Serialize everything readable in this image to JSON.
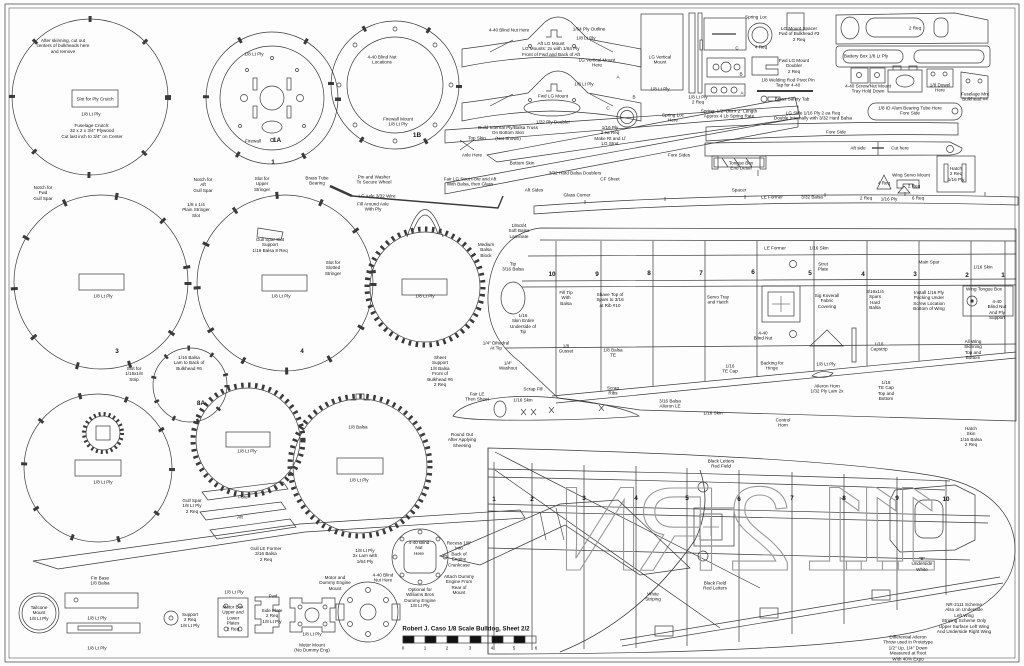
{
  "sheet": {
    "title": "Robert J. Caso 1/8 Scale Bulldog, Sheet 2/2",
    "line_color": "#3a3a3a",
    "letter_color": "#9a9a9a"
  },
  "registration": {
    "letters": [
      "N",
      "R",
      "2",
      "1",
      "1",
      "1"
    ],
    "x": [
      600,
      678,
      760,
      837,
      874,
      910
    ],
    "y": 570,
    "meaning": "NR-2111 registration drawn mirrored on lower wing"
  },
  "annotations": [
    {
      "x": 63,
      "y": 46,
      "t": "After skinning, cut out\ncenters of bulkheads here\nand remove"
    },
    {
      "x": 95,
      "y": 99,
      "t": "Slot for Ply Crutch"
    },
    {
      "x": 91,
      "y": 114,
      "t": "1/8 Lt Ply"
    },
    {
      "x": 92,
      "y": 131,
      "t": "Fuselage Crutch:\n32 x 2 x 3/4\" Plywood\nCut last inch to 3/4\" on Center"
    },
    {
      "x": 254,
      "y": 54,
      "t": "1/8 Lt Ply"
    },
    {
      "x": 253,
      "y": 141,
      "t": "Firewall"
    },
    {
      "x": 277,
      "y": 141,
      "t": "1A",
      "c": "m"
    },
    {
      "x": 273,
      "y": 163,
      "t": "1",
      "c": "m"
    },
    {
      "x": 382,
      "y": 60,
      "t": "4-40 Blind Nut\nLocations"
    },
    {
      "x": 398,
      "y": 122,
      "t": "Firewall Mount\n1/8 Lt Ply"
    },
    {
      "x": 417,
      "y": 136,
      "t": "1B",
      "c": "m"
    },
    {
      "x": 43,
      "y": 193,
      "t": "Notch for\nFwd\nGull Spar"
    },
    {
      "x": 203,
      "y": 185,
      "t": "Notch for\nAft\nGull Spar"
    },
    {
      "x": 196,
      "y": 210,
      "t": "1/8 x 1/4\nPlain Stringer\nSlot"
    },
    {
      "x": 262,
      "y": 184,
      "t": "Slot for\nUpper\nStringer"
    },
    {
      "x": 270,
      "y": 245,
      "t": "Gull Spar Slot\nSupport\n1/16 Balsa 8 Req"
    },
    {
      "x": 317,
      "y": 181,
      "t": "Brass Tube\nBearing"
    },
    {
      "x": 374,
      "y": 180,
      "t": "Pin and Washer\nTo Secure Wheel"
    },
    {
      "x": 377,
      "y": 196,
      "t": "LG Axle 3/32 Wire"
    },
    {
      "x": 373,
      "y": 207,
      "t": "Fill Around Axle\nWith Ply"
    },
    {
      "x": 103,
      "y": 296,
      "t": "1/8 Lt Ply"
    },
    {
      "x": 117,
      "y": 352,
      "t": "3",
      "c": "m"
    },
    {
      "x": 333,
      "y": 268,
      "t": "Slot for\nSlotted\nStringer"
    },
    {
      "x": 281,
      "y": 296,
      "t": "1/8 Lt Ply"
    },
    {
      "x": 302,
      "y": 352,
      "t": "4",
      "c": "m"
    },
    {
      "x": 425,
      "y": 296,
      "t": "1/8 Lt Ply"
    },
    {
      "x": 134,
      "y": 374,
      "t": "Slot for\n1/16x1/8\nStrip"
    },
    {
      "x": 189,
      "y": 363,
      "t": "1/16 Balsa\nLam to Back of\nBulkhead #6"
    },
    {
      "x": 440,
      "y": 371,
      "t": "Sheet\nSupport\n1/8 Balsa\nFront of\nBulkhead #6\n2 Req"
    },
    {
      "x": 201,
      "y": 404,
      "t": "8A",
      "c": "m"
    },
    {
      "x": 103,
      "y": 482,
      "t": "1/8 Lt Ply"
    },
    {
      "x": 192,
      "y": 506,
      "t": "Gull Spar\n1/8 Lt Ply\n2 Req"
    },
    {
      "x": 243,
      "y": 497,
      "t": "Fore"
    },
    {
      "x": 240,
      "y": 517,
      "t": "Aft"
    },
    {
      "x": 266,
      "y": 554,
      "t": "Gull LE Former\n3/16 Balsa\n2 Req"
    },
    {
      "x": 247,
      "y": 451,
      "t": "1/8 Lt Ply"
    },
    {
      "x": 358,
      "y": 427,
      "t": "1/8 Balsa"
    },
    {
      "x": 359,
      "y": 480,
      "t": "1/8 Lt Ply"
    },
    {
      "x": 477,
      "y": 397,
      "t": "Fair LE\nThen Sheet"
    },
    {
      "x": 462,
      "y": 440,
      "t": "Round Out\nAfter Applying\nSheeting"
    },
    {
      "x": 523,
      "y": 400,
      "t": "1/16 Skin"
    },
    {
      "x": 100,
      "y": 581,
      "t": "Fin Base\n1/8 Balsa"
    },
    {
      "x": 39,
      "y": 613,
      "t": "Tailcone\nMount\n1/8 Lt Ply"
    },
    {
      "x": 97,
      "y": 618,
      "t": "1/8 Lt Ply"
    },
    {
      "x": 97,
      "y": 648,
      "t": "1/8 Lt Ply"
    },
    {
      "x": 190,
      "y": 620,
      "t": "Support\n2 Req\n1/8 Lt Ply"
    },
    {
      "x": 234,
      "y": 592,
      "t": "1/8 Lt Ply"
    },
    {
      "x": 233,
      "y": 618,
      "t": "Motor Box\nUpper and\nLower\nPlates\n2 Req"
    },
    {
      "x": 273,
      "y": 596,
      "t": "Fwd"
    },
    {
      "x": 272,
      "y": 616,
      "t": "Side Plate\n2 Req\n1/8 Lt Ply"
    },
    {
      "x": 312,
      "y": 634,
      "t": "1/8 Lt Ply"
    },
    {
      "x": 312,
      "y": 648,
      "t": "Motor Mount\n(No Dummy Eng)"
    },
    {
      "x": 335,
      "y": 583,
      "t": "Motor and\nDummy Engine\nMount"
    },
    {
      "x": 365,
      "y": 556,
      "t": "1/8 Lt Ply\n2x Lam with\n1/64 Ply"
    },
    {
      "x": 383,
      "y": 578,
      "t": "4-40 Blind\nNut Here"
    },
    {
      "x": 419,
      "y": 548,
      "t": "4-40 Blind\nNut\nHere"
    },
    {
      "x": 420,
      "y": 598,
      "t": "Optional for\nWilliams Bros\nDummy Engine\n1/8 Lt Ply"
    },
    {
      "x": 459,
      "y": 554,
      "t": "Recess 1/8\"\nInto\nBack of\nEngine\nCrankcase"
    },
    {
      "x": 459,
      "y": 585,
      "t": "Attach Dummy\nEngine From\nRear of\nMount"
    },
    {
      "x": 509,
      "y": 30,
      "t": "4-40 Blind Nut Here"
    },
    {
      "x": 589,
      "y": 29,
      "t": "1/64 Ply Outline"
    },
    {
      "x": 586,
      "y": 38,
      "t": "1/8 Lt Ply"
    },
    {
      "x": 551,
      "y": 49,
      "t": "Aft LG Mount\nLG Mounts: 2x with 1/64 Ply\nFront of Fwd and Back of Aft"
    },
    {
      "x": 597,
      "y": 63,
      "t": "LG Vertical Mount\nHere"
    },
    {
      "x": 553,
      "y": 96,
      "t": "Fwd LG Mount"
    },
    {
      "x": 584,
      "y": 84,
      "t": "1/8 Lt Ply"
    },
    {
      "x": 618,
      "y": 77,
      "t": "A"
    },
    {
      "x": 634,
      "y": 97,
      "t": "B"
    },
    {
      "x": 608,
      "y": 108,
      "t": "C"
    },
    {
      "x": 553,
      "y": 122,
      "t": "1/32 Ply Doubler"
    },
    {
      "x": 660,
      "y": 60,
      "t": "LG Vertical\nMount"
    },
    {
      "x": 660,
      "y": 89,
      "t": "1/8 Lt Ply"
    },
    {
      "x": 698,
      "y": 100,
      "t": "1/8 Lt Ply\n2 Req"
    },
    {
      "x": 673,
      "y": 118,
      "t": "Spring Loc\nHere"
    },
    {
      "x": 610,
      "y": 136,
      "t": "1/16 Ply\n2 ea Req\nMake Rt and Lf\nLG Strut"
    },
    {
      "x": 508,
      "y": 133,
      "t": "Build Internal Ply/Balsa Truss\nOn Bottom Skin\n(Not Shown)"
    },
    {
      "x": 477,
      "y": 138,
      "t": "Top Skin"
    },
    {
      "x": 472,
      "y": 155,
      "t": "Axle Here"
    },
    {
      "x": 522,
      "y": 163,
      "t": "Bottom Skin"
    },
    {
      "x": 575,
      "y": 173,
      "t": "3/32 Hard Balsa Doublers"
    },
    {
      "x": 610,
      "y": 179,
      "t": "CF Sheet"
    },
    {
      "x": 534,
      "y": 190,
      "t": "Aft Sides"
    },
    {
      "x": 577,
      "y": 195,
      "t": "Glass Corner"
    },
    {
      "x": 679,
      "y": 155,
      "t": "Fore Sides"
    },
    {
      "x": 470,
      "y": 182,
      "t": "Fair LG Strut Fore and Aft\nWith Balsa, then Glass"
    },
    {
      "x": 756,
      "y": 17,
      "t": "Spring Loc"
    },
    {
      "x": 761,
      "y": 47,
      "t": "4 Req"
    },
    {
      "x": 799,
      "y": 34,
      "t": "LG Mount Spacer\nFwd of Bulkhead #3\n2 Req"
    },
    {
      "x": 794,
      "y": 66,
      "t": "Fwd LG Mount\nDoubler\n2 Req"
    },
    {
      "x": 788,
      "y": 83,
      "t": "1/8 Welding Rod Pivot Pin\nTap for 4-40"
    },
    {
      "x": 792,
      "y": 99,
      "t": "Brass Safety Tab"
    },
    {
      "x": 729,
      "y": 114,
      "t": "Spring: 1/2\" Dia x 2\" Length\nApprox 4 Lb Spring Rate"
    },
    {
      "x": 813,
      "y": 116,
      "t": "LG Side 1/16 Ply 2 ea Req\nDouble Internally with 3/32 Hard Balsa"
    },
    {
      "x": 915,
      "y": 28,
      "t": "2 Req"
    },
    {
      "x": 866,
      "y": 56,
      "t": "Battery Box 1/8 Lt Ply"
    },
    {
      "x": 868,
      "y": 89,
      "t": "4-40 Screw/Nut Mount\nTray Hold Down"
    },
    {
      "x": 940,
      "y": 88,
      "t": "1/8 Dowel\nHere"
    },
    {
      "x": 975,
      "y": 97,
      "t": "Fuselage Mnt\nBulkhead #4"
    },
    {
      "x": 910,
      "y": 111,
      "t": "1/8 ID Alum Bearing Tube Here\nFore Side"
    },
    {
      "x": 836,
      "y": 132,
      "t": "Fore Side"
    },
    {
      "x": 858,
      "y": 148,
      "t": "Aft side"
    },
    {
      "x": 900,
      "y": 148,
      "t": "Cut here"
    },
    {
      "x": 741,
      "y": 166,
      "t": "Tongue Box\nEnd Detail"
    },
    {
      "x": 739,
      "y": 190,
      "t": "Spacer"
    },
    {
      "x": 911,
      "y": 175,
      "t": "Wing Servo Mount"
    },
    {
      "x": 884,
      "y": 183,
      "t": "4 Req"
    },
    {
      "x": 914,
      "y": 186,
      "t": "2 Req"
    },
    {
      "x": 889,
      "y": 199,
      "t": "1/16 Ply"
    },
    {
      "x": 918,
      "y": 198,
      "t": "6 Req"
    },
    {
      "x": 956,
      "y": 174,
      "t": "Hatch\n2 Req\n1/16 Ply"
    },
    {
      "x": 737,
      "y": 48,
      "t": "C"
    },
    {
      "x": 741,
      "y": 74,
      "t": "B"
    },
    {
      "x": 742,
      "y": 93,
      "t": "A"
    },
    {
      "x": 772,
      "y": 197,
      "t": "LE Former"
    },
    {
      "x": 812,
      "y": 197,
      "t": "3/32 Balsa"
    },
    {
      "x": 866,
      "y": 198,
      "t": "2 Req"
    },
    {
      "x": 519,
      "y": 231,
      "t": "1/8x3/4\nSoft Balsa\nLaminate"
    },
    {
      "x": 486,
      "y": 250,
      "t": "Medium\nBalsa\nBlock"
    },
    {
      "x": 513,
      "y": 267,
      "t": "Tip\n3/16 Balsa"
    },
    {
      "x": 566,
      "y": 298,
      "t": "Fill Tip\nWith\nBalsa"
    },
    {
      "x": 610,
      "y": 300,
      "t": "Shave Top of\nSpars to 3/16\nat Rib #10"
    },
    {
      "x": 523,
      "y": 324,
      "t": "1/16\nSkin Entire\nUnderside of\nTip"
    },
    {
      "x": 718,
      "y": 300,
      "t": "Servo Tray\nand Hatch"
    },
    {
      "x": 496,
      "y": 346,
      "t": "1/4\" Dihedral\nAt Tip"
    },
    {
      "x": 508,
      "y": 366,
      "t": "1/4\"\nWashout"
    },
    {
      "x": 566,
      "y": 349,
      "t": "1/8\nGusset"
    },
    {
      "x": 613,
      "y": 353,
      "t": "1/8 Balsa\nTE"
    },
    {
      "x": 533,
      "y": 389,
      "t": "Scrap Fill"
    },
    {
      "x": 613,
      "y": 391,
      "t": "Scrap\nRibs"
    },
    {
      "x": 670,
      "y": 404,
      "t": "3/16 Balsa\nAileron LE"
    },
    {
      "x": 713,
      "y": 413,
      "t": "1/16 Skin"
    },
    {
      "x": 730,
      "y": 369,
      "t": "1/16\nTE Cap"
    },
    {
      "x": 763,
      "y": 336,
      "t": "4-40\nBlind Nut"
    },
    {
      "x": 775,
      "y": 248,
      "t": "LE Former"
    },
    {
      "x": 819,
      "y": 248,
      "t": "1/16 Skin"
    },
    {
      "x": 823,
      "y": 267,
      "t": "Strut\nPlate"
    },
    {
      "x": 929,
      "y": 262,
      "t": "Main Spar"
    },
    {
      "x": 983,
      "y": 267,
      "t": "1/16 Skin"
    },
    {
      "x": 827,
      "y": 301,
      "t": "Sig Koverall\nFabric\nCovering"
    },
    {
      "x": 875,
      "y": 300,
      "t": "3/16x1/4\nSpars\nHard\nBalsa"
    },
    {
      "x": 929,
      "y": 301,
      "t": "Install 1/16 Ply\nPacking Under\nScrew Location\nBottom of Wing"
    },
    {
      "x": 984,
      "y": 289,
      "t": "Wing Tongue Box"
    },
    {
      "x": 997,
      "y": 310,
      "t": "4-40\nBlind Nut\nAnd Ply\nSupport"
    },
    {
      "x": 879,
      "y": 347,
      "t": "1/16\nCapstrip"
    },
    {
      "x": 826,
      "y": 364,
      "t": "1/8 Lt Ply"
    },
    {
      "x": 827,
      "y": 389,
      "t": "Aileron Horn\n1/32 Ply Lam 2x"
    },
    {
      "x": 886,
      "y": 391,
      "t": "1/16\nTE Cap\nTop and\nBottom"
    },
    {
      "x": 973,
      "y": 350,
      "t": "All Wing\nSkinning\nTop and\nBottom"
    },
    {
      "x": 772,
      "y": 366,
      "t": "Backing for\nHinge"
    },
    {
      "x": 783,
      "y": 423,
      "t": "Control\nHorn"
    },
    {
      "x": 721,
      "y": 464,
      "t": "Black Letters\nRed Field"
    },
    {
      "x": 715,
      "y": 586,
      "t": "Black Field\nRed Letters"
    },
    {
      "x": 653,
      "y": 597,
      "t": "White\nStriping"
    },
    {
      "x": 922,
      "y": 564,
      "t": "\"B\"\nUnderside\nWhite"
    },
    {
      "x": 964,
      "y": 618,
      "t": "NR-2111 Scheme\nAlso on Underside\nLeft Wing\nStriping Scheme Only\nUpper Surface Left Wing\nAnd Underside Right Wing"
    },
    {
      "x": 908,
      "y": 648,
      "t": "Differential Aileron\nThrow used in Prototype\n1/2\" Up, 1/4\" Down\nMeasured at Root\nWith 40% Expo"
    },
    {
      "x": 971,
      "y": 437,
      "t": "Hatch\nSkin\n1/16 Balsa\n2 Req"
    },
    {
      "x": 552,
      "y": 275,
      "t": "10",
      "c": "m"
    },
    {
      "x": 597,
      "y": 275,
      "t": "9",
      "c": "m"
    },
    {
      "x": 649,
      "y": 274,
      "t": "8",
      "c": "m"
    },
    {
      "x": 701,
      "y": 274,
      "t": "7",
      "c": "m"
    },
    {
      "x": 753,
      "y": 273,
      "t": "6",
      "c": "m"
    },
    {
      "x": 810,
      "y": 274,
      "t": "5",
      "c": "m"
    },
    {
      "x": 863,
      "y": 275,
      "t": "4",
      "c": "m"
    },
    {
      "x": 915,
      "y": 275,
      "t": "3",
      "c": "m"
    },
    {
      "x": 967,
      "y": 276,
      "t": "2",
      "c": "m"
    },
    {
      "x": 1003,
      "y": 276,
      "t": "1",
      "c": "m"
    },
    {
      "x": 494,
      "y": 500,
      "t": "1",
      "c": "m"
    },
    {
      "x": 532,
      "y": 500,
      "t": "2",
      "c": "m"
    },
    {
      "x": 584,
      "y": 499,
      "t": "3",
      "c": "m"
    },
    {
      "x": 636,
      "y": 499,
      "t": "4",
      "c": "m"
    },
    {
      "x": 687,
      "y": 499,
      "t": "5",
      "c": "m"
    },
    {
      "x": 739,
      "y": 500,
      "t": "6",
      "c": "m"
    },
    {
      "x": 792,
      "y": 499,
      "t": "7",
      "c": "m"
    },
    {
      "x": 844,
      "y": 499,
      "t": "8",
      "c": "m"
    },
    {
      "x": 897,
      "y": 499,
      "t": "9",
      "c": "m"
    },
    {
      "x": 946,
      "y": 500,
      "t": "10",
      "c": "m"
    },
    {
      "x": 403,
      "y": 648,
      "t": "0"
    },
    {
      "x": 425,
      "y": 648,
      "t": "1"
    },
    {
      "x": 447,
      "y": 648,
      "t": "2"
    },
    {
      "x": 470,
      "y": 648,
      "t": "3"
    },
    {
      "x": 492,
      "y": 648,
      "t": "4"
    },
    {
      "x": 514,
      "y": 648,
      "t": "5"
    },
    {
      "x": 536,
      "y": 648,
      "t": "6"
    }
  ]
}
